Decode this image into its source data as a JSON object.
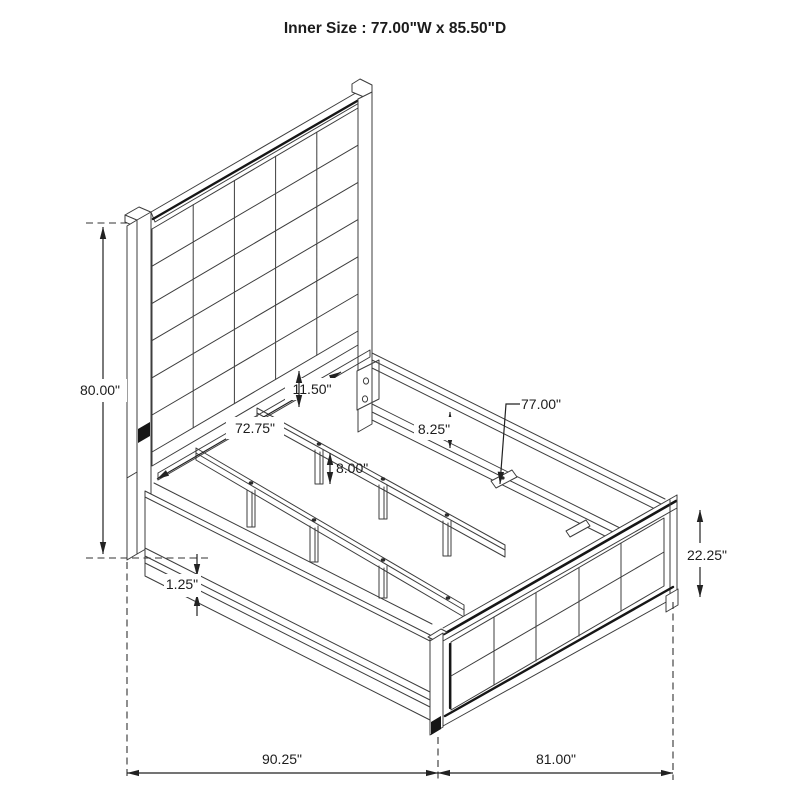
{
  "title": "Inner Size : 77.00\"W x 85.50\"D",
  "dimensions": {
    "overall_height": "80.00\"",
    "headboard_inner_width": "72.75\"",
    "headboard_clearance": "11.50\"",
    "support_leg_height": "8.00\"",
    "side_rail_height": "8.25\"",
    "slat_rail_length": "77.00\"",
    "footboard_height": "22.25\"",
    "base_trim_thickness": "1.25\"",
    "overall_depth_span": "90.25\"",
    "overall_width_span": "81.00\""
  }
}
